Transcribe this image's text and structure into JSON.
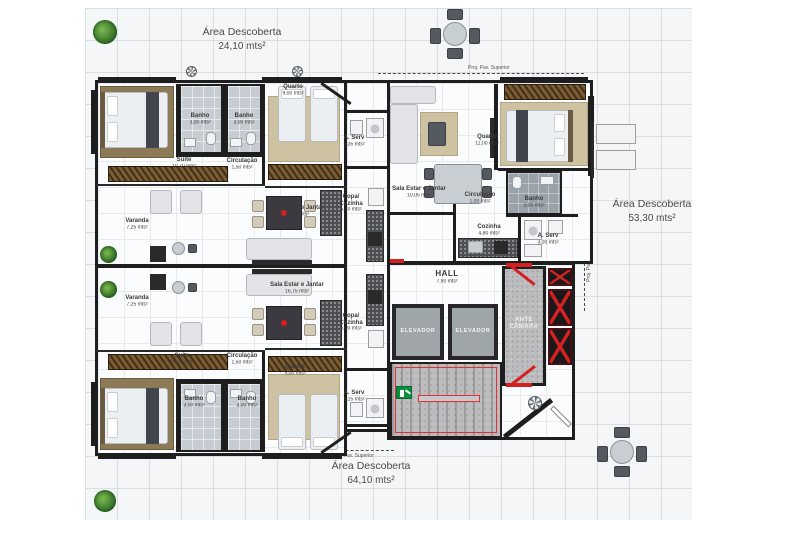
{
  "plan_title": "Floor plan",
  "outdoor": {
    "areas": [
      {
        "name": "Área Descoberta",
        "area": "24,10 mts²"
      },
      {
        "name": "Área Descoberta",
        "area": "53,30 mts²"
      },
      {
        "name": "Área Descoberta",
        "area": "64,10 mts²"
      }
    ],
    "projection": "Proj. Pav. Superior"
  },
  "rooms": [
    {
      "name": "Suíte",
      "area": "10,70 mts²"
    },
    {
      "name": "Banho",
      "area": "3,00 mts²"
    },
    {
      "name": "Banho",
      "area": "3,00 mts²"
    },
    {
      "name": "Circulação",
      "area": "1,50 mts²"
    },
    {
      "name": "Quarto",
      "area": "9,00 mts²"
    },
    {
      "name": "A. Serv",
      "area": "2,35 mts²"
    },
    {
      "name": "Copa/ Cozinha",
      "area": "5,70 mts²"
    },
    {
      "name": "Sala Estar e Jantar",
      "area": "16,75 mts²"
    },
    {
      "name": "Varanda",
      "area": "7,25 mts²"
    },
    {
      "name": "Varanda",
      "area": "7,25 mts²"
    },
    {
      "name": "Sala Estar e Jantar",
      "area": "16,75 mts²"
    },
    {
      "name": "Copa/ Cozinha",
      "area": "5,00 mts²"
    },
    {
      "name": "Quarto",
      "area": "9,00 mts²"
    },
    {
      "name": "A. Serv",
      "area": "2,15 mts²"
    },
    {
      "name": "Suíte",
      "area": "10,70 mts²"
    },
    {
      "name": "Circulação",
      "area": "1,50 mts²"
    },
    {
      "name": "Banho",
      "area": "3,00 mts²"
    },
    {
      "name": "Banho",
      "area": "3,00 mts²"
    },
    {
      "name": "Sala Estar e Jantar",
      "area": "10,05 mts²"
    },
    {
      "name": "Quarto",
      "area": "11,00 mts²"
    },
    {
      "name": "Circulação",
      "area": "1,00 mts²"
    },
    {
      "name": "Cozinha",
      "area": "4,80 mts²"
    },
    {
      "name": "Banho",
      "area": "3,00 mts²"
    },
    {
      "name": "A. Serv",
      "area": "3,00 mts²"
    },
    {
      "name": "HALL",
      "area": "7,90 mts²"
    }
  ],
  "core": {
    "elevator": "ELEVADOR",
    "ante_camara": "ANTE CÂMARA"
  },
  "colors": {
    "wall": "#1e1e1e",
    "accent_red": "#d42020",
    "exit_green": "#0a8f3e"
  }
}
